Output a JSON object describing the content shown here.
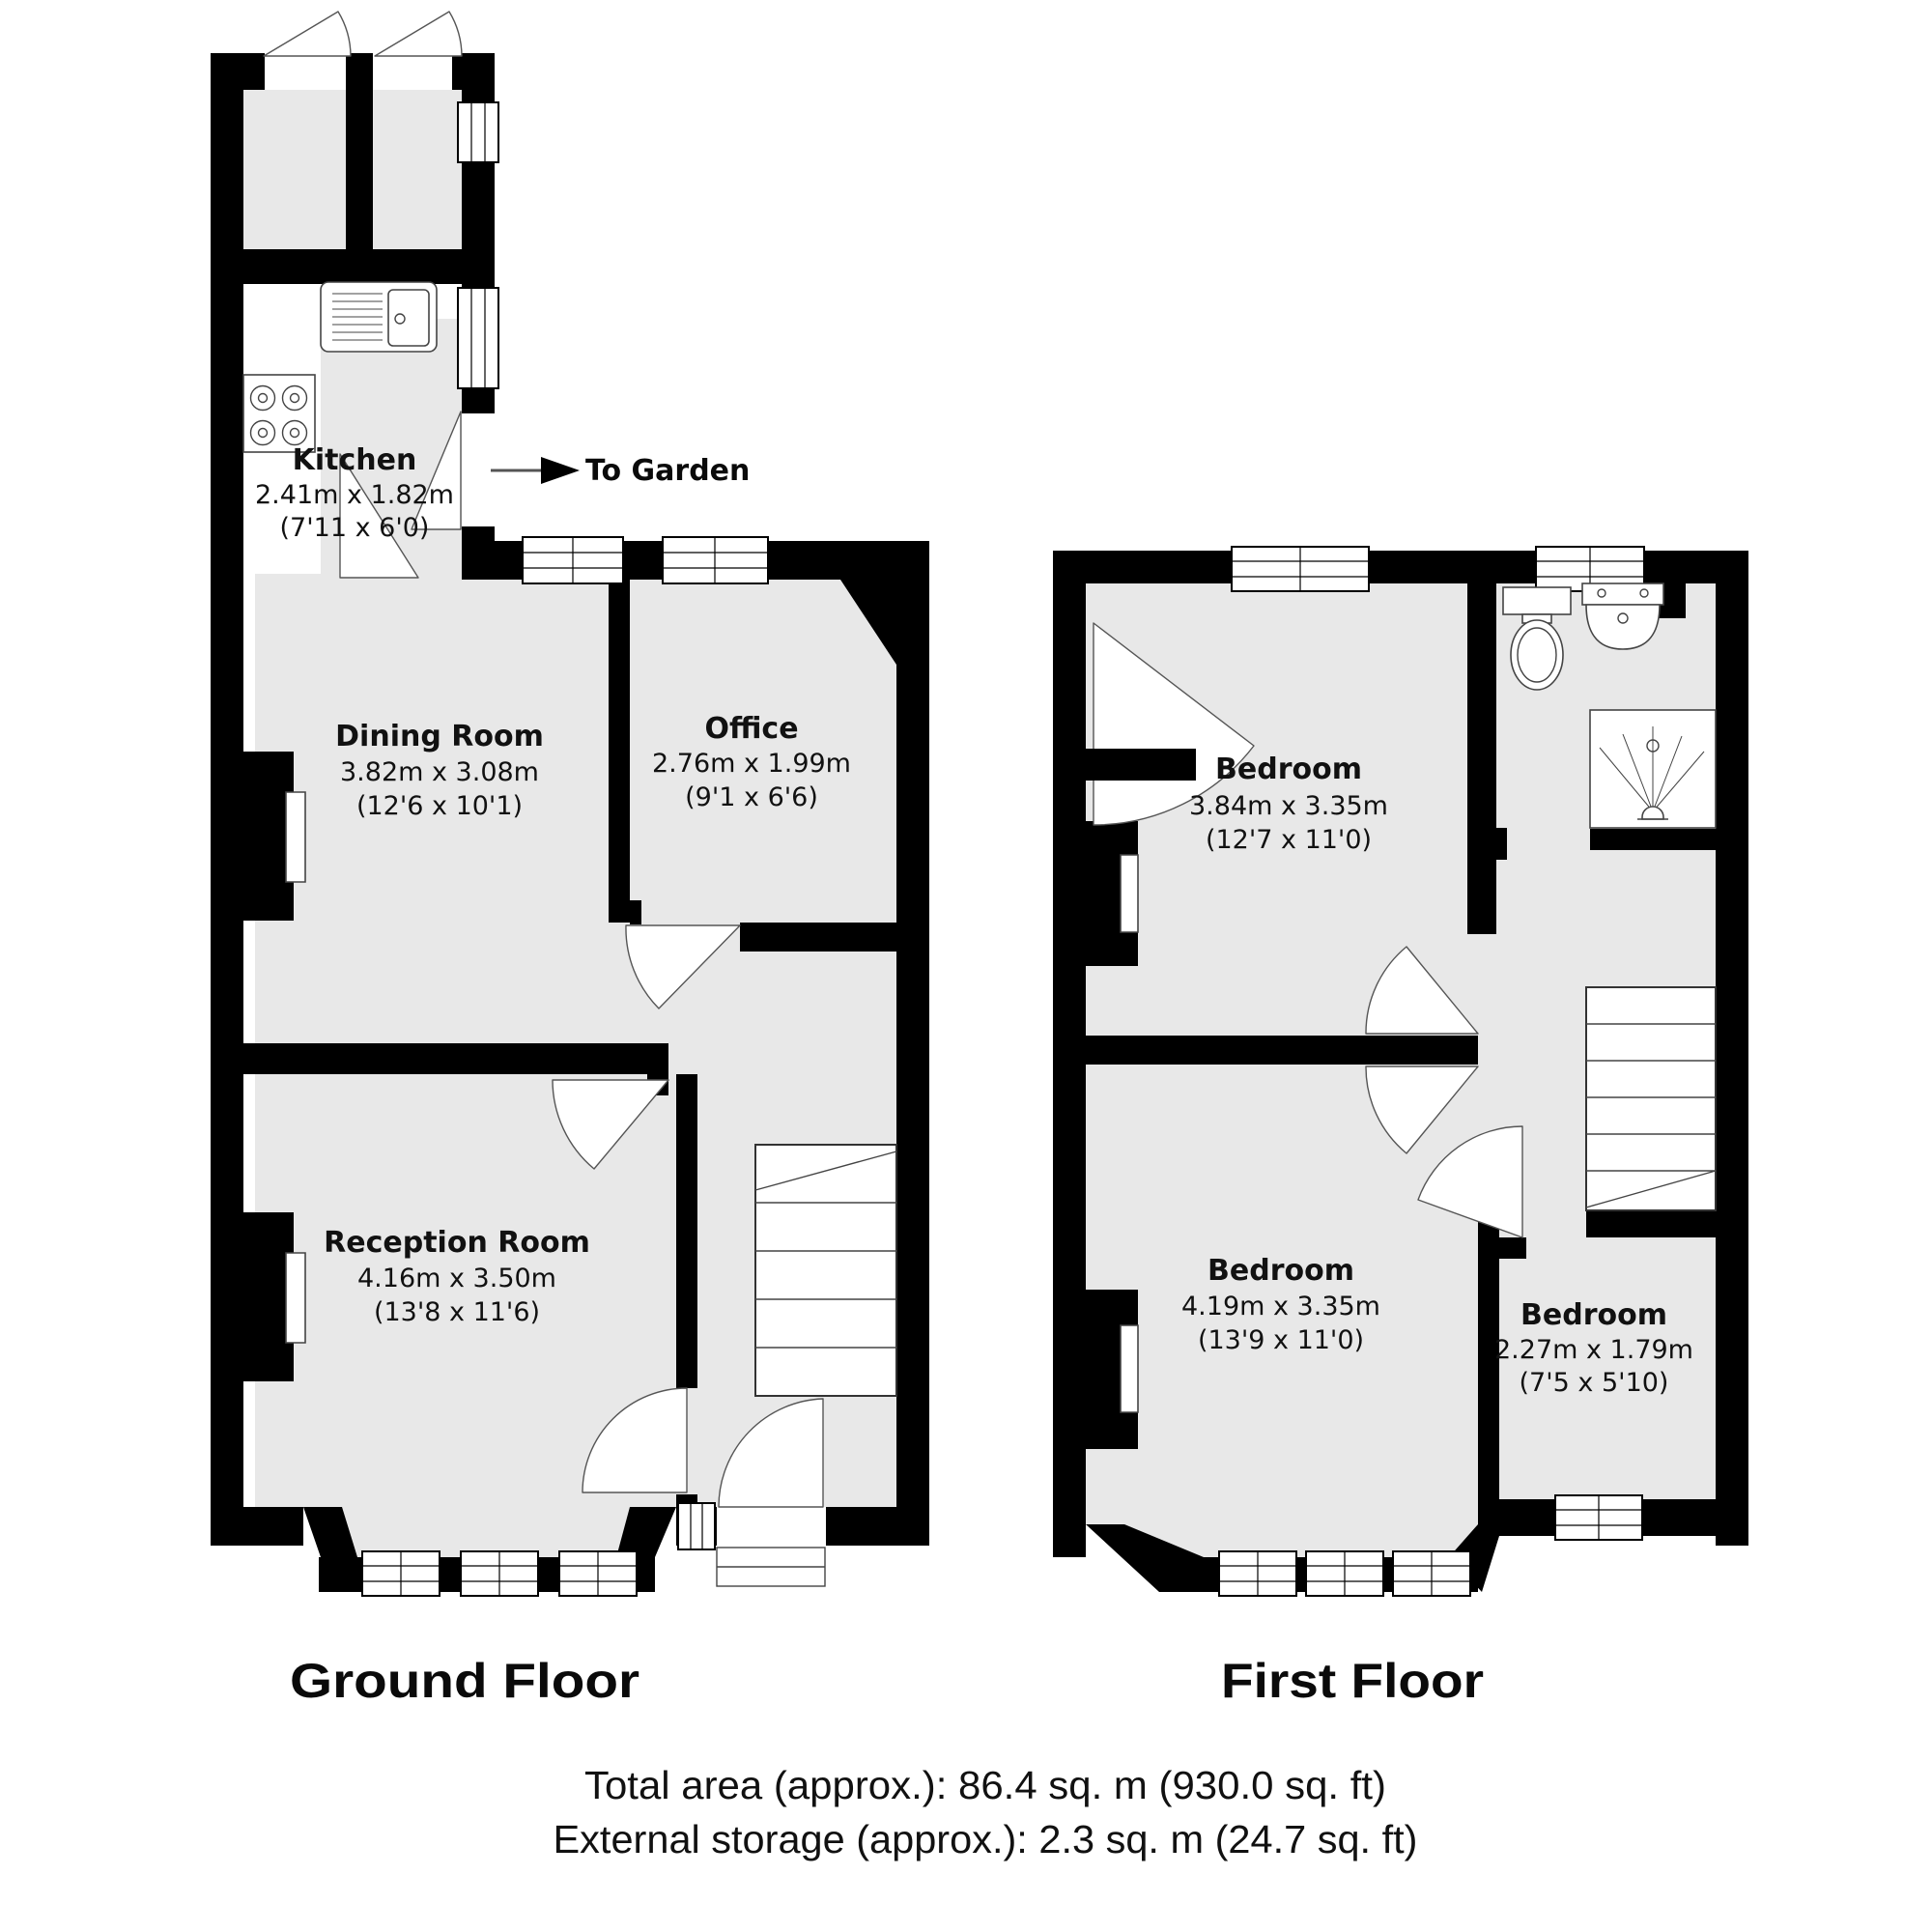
{
  "ground_floor": {
    "title": "Ground Floor",
    "to_garden_label": "To Garden",
    "rooms": {
      "kitchen": {
        "name": "Kitchen",
        "metric": "2.41m x 1.82m",
        "imperial": "(7'11 x 6'0)"
      },
      "dining_room": {
        "name": "Dining Room",
        "metric": "3.82m x 3.08m",
        "imperial": "(12'6 x 10'1)"
      },
      "office": {
        "name": "Office",
        "metric": "2.76m x 1.99m",
        "imperial": "(9'1 x 6'6)"
      },
      "reception_room": {
        "name": "Reception Room",
        "metric": "4.16m x 3.50m",
        "imperial": "(13'8 x 11'6)"
      }
    }
  },
  "first_floor": {
    "title": "First Floor",
    "rooms": {
      "bedroom_front": {
        "name": "Bedroom",
        "metric": "3.84m x 3.35m",
        "imperial": "(12'7 x 11'0)"
      },
      "bedroom_large": {
        "name": "Bedroom",
        "metric": "4.19m x 3.35m",
        "imperial": "(13'9 x 11'0)"
      },
      "bedroom_small": {
        "name": "Bedroom",
        "metric": "2.27m x 1.79m",
        "imperial": "(7'5 x 5'10)"
      }
    }
  },
  "summary": {
    "total_area": "Total area (approx.): 86.4 sq. m (930.0 sq. ft)",
    "external_storage": "External storage (approx.): 2.3 sq. m (24.7 sq. ft)"
  },
  "icons": {
    "to_garden_arrow": "right-arrow",
    "stairs": "stairs",
    "toilet": "toilet",
    "washbasin": "washbasin",
    "shower": "shower",
    "kitchen_sink": "kitchen-sink",
    "hob": "hob-4-burners",
    "fireplace": "chimney-breast-recess",
    "door_swing": "door-swing-arc",
    "window": "double-line-window"
  },
  "colors": {
    "wall": "#000000",
    "floor": "#e8e8e8",
    "background": "#ffffff",
    "line": "#555555"
  }
}
